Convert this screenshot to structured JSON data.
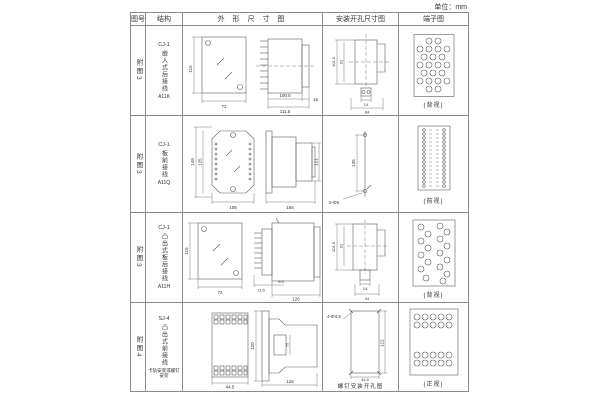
{
  "unit_label": "单位：mm",
  "table": {
    "headers": [
      "图号",
      "结构",
      "外 形 尺 寸 图",
      "安装开孔尺寸图",
      "端子图"
    ],
    "rows": [
      {
        "fig": "附图3",
        "model": "CJ-1",
        "desc": "嵌入式后接线",
        "code": "A11K",
        "outline": {
          "h": "115",
          "w": "72",
          "d1": "100.5",
          "d2": "111.5",
          "f": "16"
        },
        "install": {
          "v1": "101.5",
          "v2": "91",
          "b1": "14",
          "b2": "84"
        },
        "terminal": {
          "caption": "(背视)"
        }
      },
      {
        "fig": "附图3",
        "model": "CJ-1",
        "desc": "板前接线",
        "code": "A11Q",
        "outline": {
          "h1": "149",
          "h2": "125",
          "w": "105",
          "len": "156",
          "side": "121"
        },
        "install": {
          "v": "135",
          "hole": "2-Φ6"
        },
        "terminal": {
          "caption": "(前视)"
        }
      },
      {
        "fig": "附图3",
        "model": "CJ-1",
        "desc": "凸出式板后接线",
        "code": "A11H",
        "outline": {
          "h": "115",
          "w": "72",
          "d1": "11.5",
          "d2": "9.5",
          "len": "126"
        },
        "install": {
          "v1": "101.5",
          "v2": "91",
          "b1": "14",
          "b2": "44"
        },
        "terminal": {
          "caption": "(背视)"
        }
      },
      {
        "fig": "附图4",
        "model": "SJ-4",
        "desc": "凸出式前接线",
        "note": "卡轨安装或螺钉安装",
        "outline": {
          "w": "44.5",
          "h": "120",
          "inner": "75",
          "len": "128"
        },
        "install": {
          "hole": "4-Φ4.5",
          "v": "112",
          "b": "44.5",
          "caption": "螺钉安装开孔图"
        },
        "terminal": {
          "caption": "(正视)"
        }
      }
    ]
  }
}
